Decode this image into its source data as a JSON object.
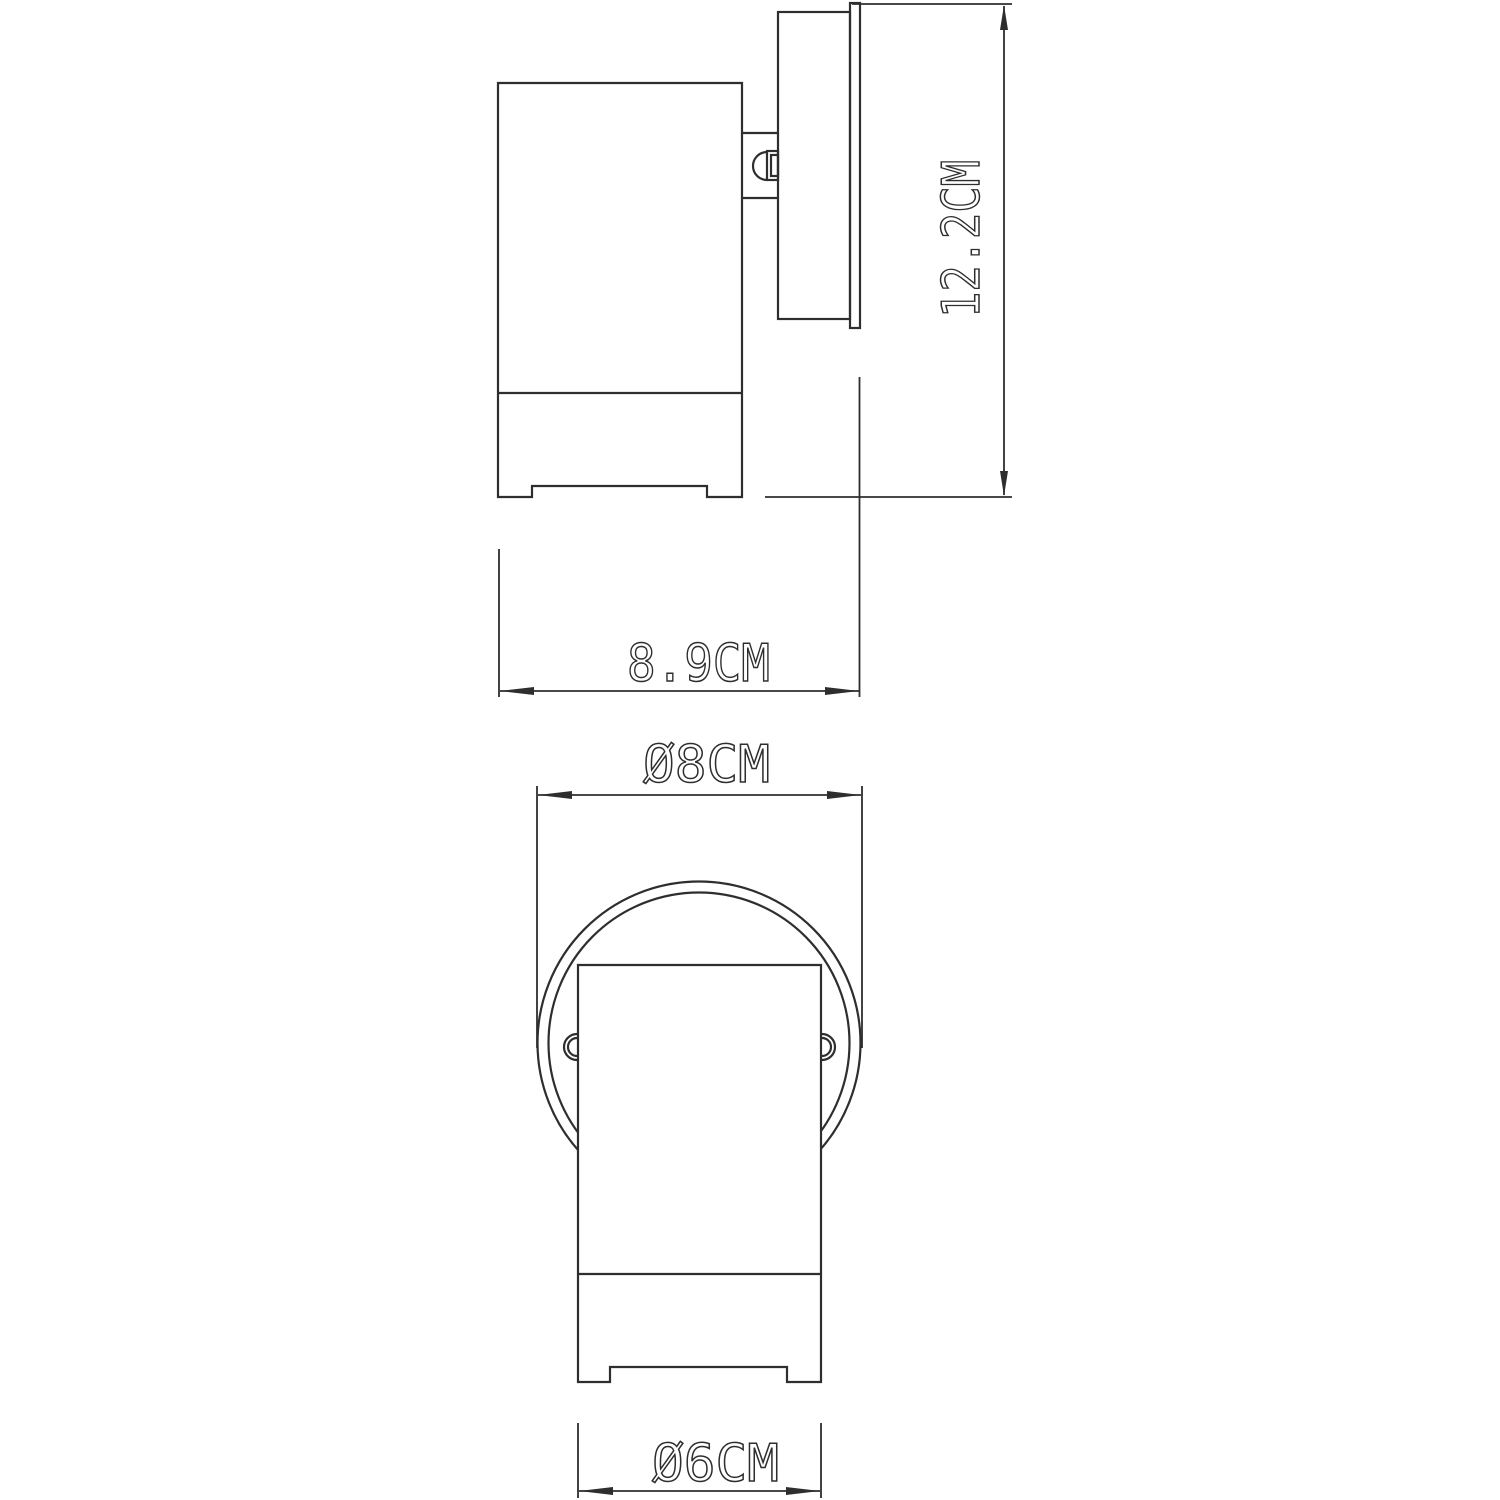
{
  "page": {
    "background_color": "#ffffff",
    "line_color": "#2e2e2e"
  },
  "drawing": {
    "type": "technical-dimension-drawing",
    "dimensions": {
      "overall_height": {
        "label": "12.2CM",
        "value": 12.2,
        "unit": "CM",
        "orientation": "vertical"
      },
      "overall_depth": {
        "label": "8.9CM",
        "value": 8.9,
        "unit": "CM",
        "orientation": "horizontal"
      },
      "backplate_diameter": {
        "label": "Ø8CM",
        "value": 8,
        "unit": "CM",
        "orientation": "horizontal"
      },
      "body_diameter": {
        "label": "Ø6CM",
        "value": 6,
        "unit": "CM",
        "orientation": "horizontal"
      }
    }
  }
}
